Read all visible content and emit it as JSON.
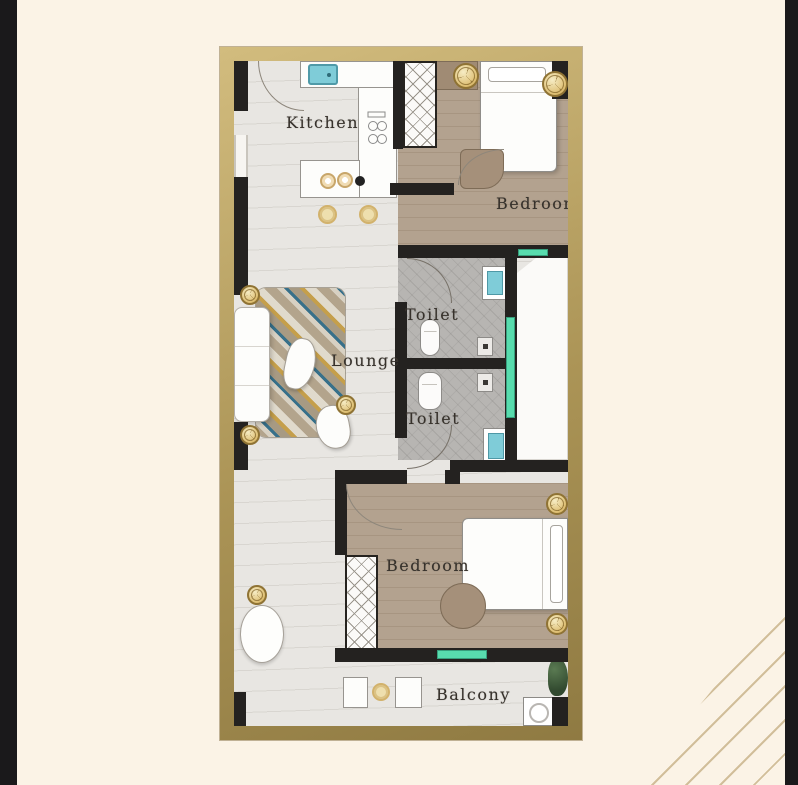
{
  "poster": {
    "kind": "apartment-floor-plan"
  },
  "theme": {
    "page_bg": "#fbf3e6",
    "edge_bar": "#1a191b",
    "frame_gold_light": "#d2bc7e",
    "frame_gold": "#ab9456",
    "frame_gold_dark": "#8f7a42",
    "wall": "#242220",
    "marble_floor": "#e8e6e2",
    "wood_floor": "#b3a28f",
    "tile_floor": "#b7b5b2",
    "shaft_white": "#fbfaf8",
    "sink_teal": "#7fccd8",
    "window_teal": "#58dcae",
    "light_gold": "#ddbe72",
    "rug_blue": "#37708a",
    "rug_gold": "#c59f4b",
    "rug_tan": "#b3a48c"
  },
  "floorplan": {
    "rooms": [
      {
        "id": "kitchen",
        "label": "Kitchen"
      },
      {
        "id": "bedroom-top",
        "label": "Bedroom"
      },
      {
        "id": "toilet-top",
        "label": "Toilet"
      },
      {
        "id": "lounge",
        "label": "Lounge"
      },
      {
        "id": "toilet-bottom",
        "label": "Toilet"
      },
      {
        "id": "bedroom-bottom",
        "label": "Bedroom"
      },
      {
        "id": "balcony",
        "label": "Balcony"
      }
    ],
    "icons": [
      "kitchen-sink-icon",
      "stove-burner-icon",
      "oven-column-icon",
      "bar-stool-icon",
      "double-bed-icon",
      "pillow-icon",
      "bedside-table-icon",
      "wardrobe-icon",
      "ceiling-light-icon",
      "door-swing-arc",
      "window-strip",
      "wc-icon",
      "wash-basin-icon",
      "cistern-icon",
      "sofa-icon",
      "area-rug",
      "coffee-table-icon",
      "dining-table-icon",
      "balcony-seat-icon",
      "washing-machine-icon",
      "plant-icon"
    ]
  }
}
